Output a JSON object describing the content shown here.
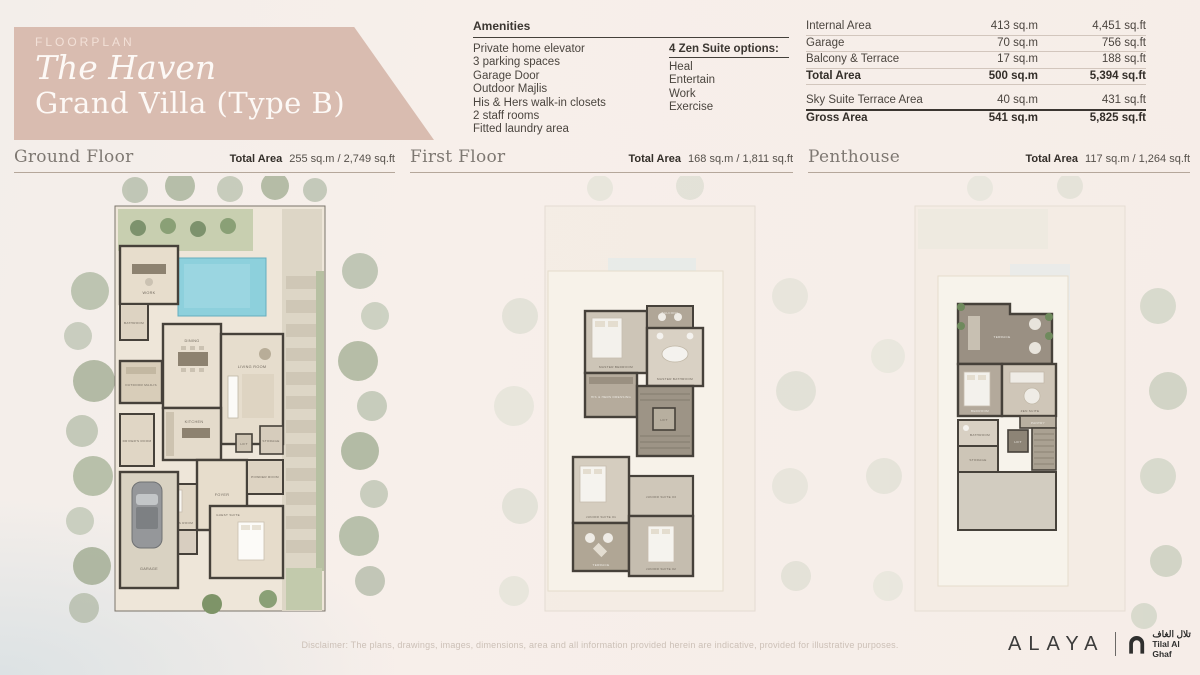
{
  "palette": {
    "header_box": "#D9BCB0",
    "wall": "#46413A",
    "pool": "#8DD0DC",
    "text_dark": "#3B3631",
    "text_muted": "#7E7872",
    "rule": "#B5A79B"
  },
  "header": {
    "eyebrow": "FLOORPLAN",
    "title_italic": "The Haven",
    "title": "Grand Villa (Type B)"
  },
  "amenities": {
    "heading": "Amenities",
    "items": [
      "Private home elevator",
      "3 parking spaces",
      "Garage Door",
      "Outdoor Majlis",
      "His & Hers walk-in closets",
      "2 staff rooms",
      "Fitted laundry area"
    ],
    "zen_heading": "4 Zen Suite options:",
    "zen_items": [
      "Heal",
      "Entertain",
      "Work",
      "Exercise"
    ]
  },
  "area_table": {
    "rows": [
      {
        "label": "Internal Area",
        "sqm": "413 sq.m",
        "sqft": "4,451 sq.ft"
      },
      {
        "label": "Garage",
        "sqm": "70 sq.m",
        "sqft": "756 sq.ft"
      },
      {
        "label": "Balcony & Terrace",
        "sqm": "17 sq.m",
        "sqft": "188 sq.ft"
      },
      {
        "label": "Total Area",
        "sqm": "500 sq.m",
        "sqft": "5,394 sq.ft"
      },
      {
        "label": "Sky Suite Terrace Area",
        "sqm": "40 sq.m",
        "sqft": "431 sq.ft"
      },
      {
        "label": "Gross Area",
        "sqm": "541 sq.m",
        "sqft": "5,825 sq.ft"
      }
    ]
  },
  "floors": [
    {
      "name": "Ground Floor",
      "total_label": "Total Area",
      "area": "255 sq.m  /  2,749 sq.ft"
    },
    {
      "name": "First Floor",
      "total_label": "Total Area",
      "area": "168 sq.m  /  1,811 sq.ft"
    },
    {
      "name": "Penthouse",
      "total_label": "Total Area",
      "area": "117 sq.m  /  1,264 sq.ft"
    }
  ],
  "plans": {
    "ground": {
      "rooms": [
        "WORK",
        "BATHROOM",
        "OUTDOOR MAJLIS",
        "DRIVER'S ROOM",
        "DINING",
        "LIVING ROOM",
        "KITCHEN",
        "MAID'S ROOM",
        "FOYER",
        "POWDER ROOM",
        "LIFT",
        "STORAGE",
        "GUEST SUITE",
        "GARAGE"
      ]
    },
    "first": {
      "rooms": [
        "MASTER BEDROOM",
        "BALCONY",
        "MASTER BATHROOM",
        "HIS & HERS DRESSING",
        "JUNIOR SUITE 03",
        "LIFT",
        "JUNIOR SUITE 01",
        "TERRACE",
        "JUNIOR SUITE 02"
      ]
    },
    "penthouse": {
      "rooms": [
        "TERRACE",
        "BEDROOM",
        "ZEN SUITE",
        "PANTRY",
        "BATHROOM",
        "STORAGE",
        "LIFT"
      ]
    }
  },
  "footer": {
    "disclaimer": "Disclaimer: The plans, drawings, images, dimensions, area and all information provided herein are indicative, provided for illustrative purposes.",
    "brand": "ALAYA",
    "partner_arabic": "تلال الغاف",
    "partner_name": "Tilal Al Ghaf"
  }
}
